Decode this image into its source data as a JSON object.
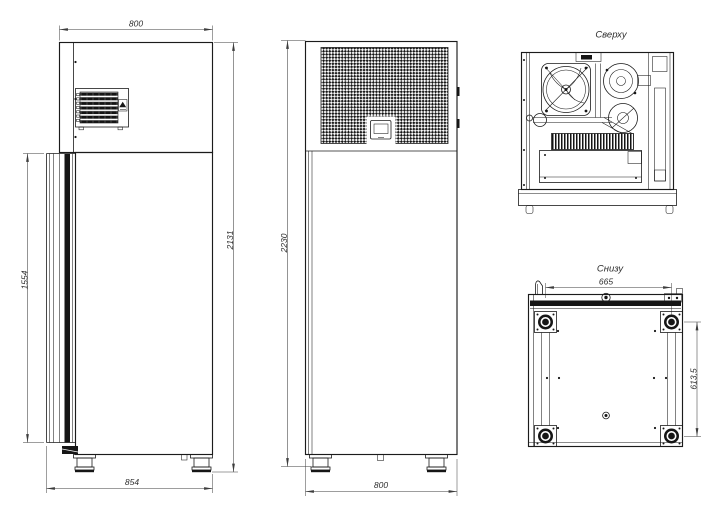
{
  "drawing": {
    "background": "#ffffff",
    "line_color": "#1b1b1b",
    "dim_color": "#3c3c3c",
    "views": {
      "side_view": {
        "dim_width_top": "800",
        "dim_door_height": "1554",
        "dim_height": "2131",
        "dim_depth_bottom": "854"
      },
      "front_view": {
        "dim_height": "2230",
        "dim_width_bottom": "800"
      },
      "top_view": {
        "title": "Сверху"
      },
      "bottom_view": {
        "title": "Снизу",
        "dim_feet_spacing_x": "665",
        "dim_feet_spacing_y": "613,5"
      }
    }
  }
}
